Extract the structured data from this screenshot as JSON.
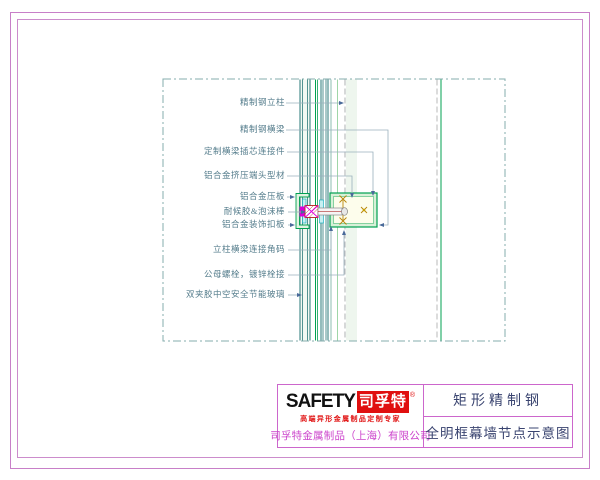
{
  "drawing": {
    "labels": [
      {
        "text": "精制钢立柱"
      },
      {
        "text": "精制钢横梁"
      },
      {
        "text": "定制横梁插芯连接件"
      },
      {
        "text": "铝合金挤压端头型材"
      },
      {
        "text": "铝合金压板"
      },
      {
        "text": "耐候胶&泡沫棒"
      },
      {
        "text": "铝合金装饰扣板"
      },
      {
        "text": "立柱横梁连接角码"
      },
      {
        "text": "公母螺栓，镀锌栓接"
      },
      {
        "text": "双夹胶中空安全节能玻璃"
      }
    ]
  },
  "title_block": {
    "logo": {
      "brand_en": "SAFETY",
      "brand_cn": "司孚特",
      "reg_mark": "®",
      "tagline": "高端异形金属制品定制专家"
    },
    "company": "司孚特金属制品（上海）有限公司",
    "product_name": "矩形精制钢",
    "drawing_title": "全明框幕墙节点示意图"
  },
  "colors": {
    "frame_violet": "#c87fc8",
    "table_border": "#cc66cc",
    "label_teal": "#557d8c",
    "leader_gray": "#9ab0bc",
    "steel_teal": "#2a7878",
    "bright_green": "#00a050",
    "pale_green_fill": "#d8f0d8",
    "beam_fill": "#fdfdec",
    "magenta": "#d800d8",
    "dark_red": "#b00000",
    "bolt_gold": "#b8860b",
    "logo_red": "#e01010",
    "title_navy": "#3a4470",
    "company_magenta": "#cc44cc"
  }
}
